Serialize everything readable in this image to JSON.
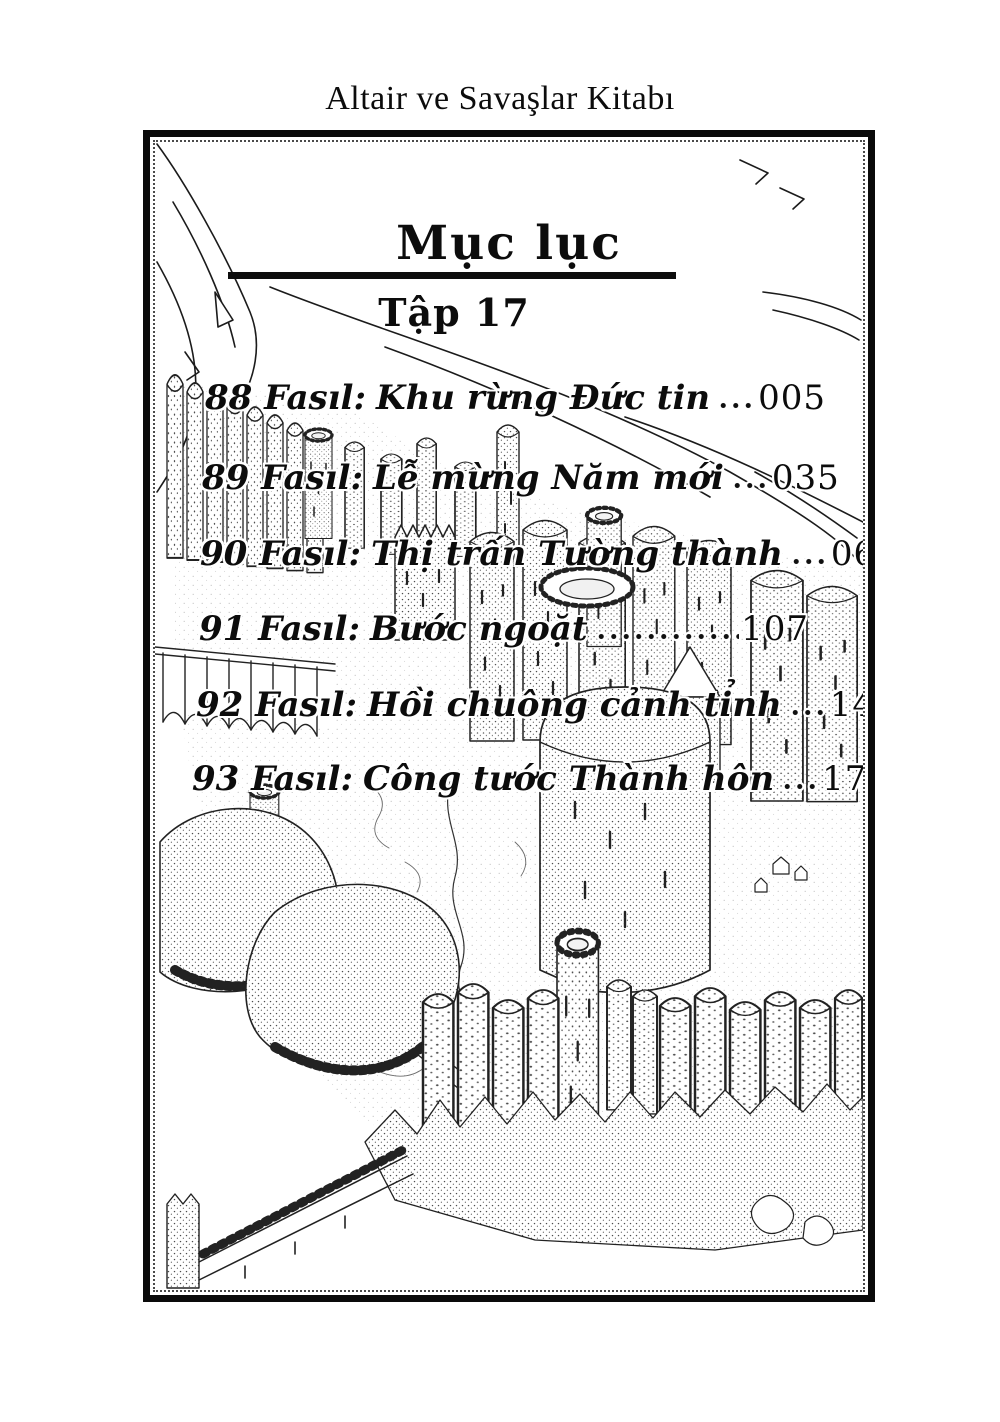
{
  "page": {
    "header_title": "Altair ve Savaşlar Kitabı"
  },
  "toc": {
    "title": "Mục lục",
    "volume": "Tập 17",
    "entries": [
      {
        "no": "88",
        "label": "Fasıl:",
        "title": "Khu rừng Đức tin",
        "page": "005"
      },
      {
        "no": "89",
        "label": "Fasıl:",
        "title": "Lễ mừng Năm mới",
        "page": "035"
      },
      {
        "no": "90",
        "label": "Fasıl:",
        "title": "Thị trấn Tường thành",
        "page": "069"
      },
      {
        "no": "91",
        "label": "Fasıl:",
        "title": "Bước ngoặt",
        "page": "107"
      },
      {
        "no": "92",
        "label": "Fasıl:",
        "title": "Hồi chuông cảnh tỉnh",
        "page": "147"
      },
      {
        "no": "93",
        "label": "Fasıl:",
        "title": "Công tước Thành hôn",
        "page": "171"
      }
    ]
  },
  "illustration": {
    "alt": "Bird's-eye pen-and-ink drawing of a walled fortress city with cylindrical towers, cliffs, aqueduct and rocky shore",
    "ink_color": "#1b1b1b",
    "paper_color": "#ffffff"
  }
}
